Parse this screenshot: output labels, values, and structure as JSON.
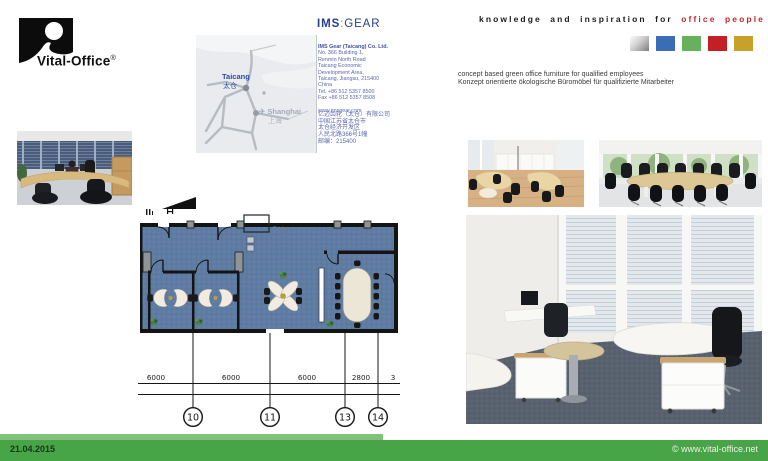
{
  "brand": {
    "name": "Vital-Office",
    "registered": "®"
  },
  "client_logo": {
    "part1": "IMS",
    "separator": ":",
    "part2": "GEAR"
  },
  "tagline": {
    "black": "knowledge and inspiration for",
    "red": "office people"
  },
  "palette_colors": [
    "silver-gradient",
    "#3a6db6",
    "#67b15e",
    "#c22026",
    "#c8a12b"
  ],
  "map": {
    "taicang_label": "Taicang",
    "taicang_cn": "太仓",
    "plane_icon": "✈",
    "shanghai_label": "Shanghai",
    "shanghai_cn": "上海"
  },
  "address_en": [
    "IMS Gear (Taicang) Co. Ltd.",
    "No. 366 Building 1,",
    "Renmin North Road",
    "Taicang Economic",
    "Development Area,",
    "Taicang, Jiangsu, 215400",
    "China",
    "Tel. +86 512 5357 8500",
    "Fax +86 512 5357 8508",
    "www.imsgear.com"
  ],
  "address_cn": [
    "亿迈齿轮（太仓）有限公司",
    "中国江苏省太仓市",
    "太仓经济开发区",
    "人民北路366号1幢",
    "邮编：215400"
  ],
  "concept": {
    "en": "concept based green office furniture for qualified employees",
    "de": "Konzept orientierte ökologische Büromöbel für qualifizierte Mitarbeiter"
  },
  "floorplan": {
    "printer_label": "Printer",
    "dimensions": [
      "6000",
      "6000",
      "6000",
      "2800",
      "3"
    ],
    "grid_bubbles": [
      "10",
      "11",
      "13",
      "14"
    ]
  },
  "footer": {
    "date": "21.04.2015",
    "site": "© www.vital-office.net"
  },
  "colors": {
    "footer_green": "#47a447",
    "footer_light_green": "#82c17a",
    "ims_navy": "#25408c",
    "tagline_red": "#c4252b",
    "address_blue": "#5c68ad",
    "plan_carpet": "#5e7ba2"
  }
}
